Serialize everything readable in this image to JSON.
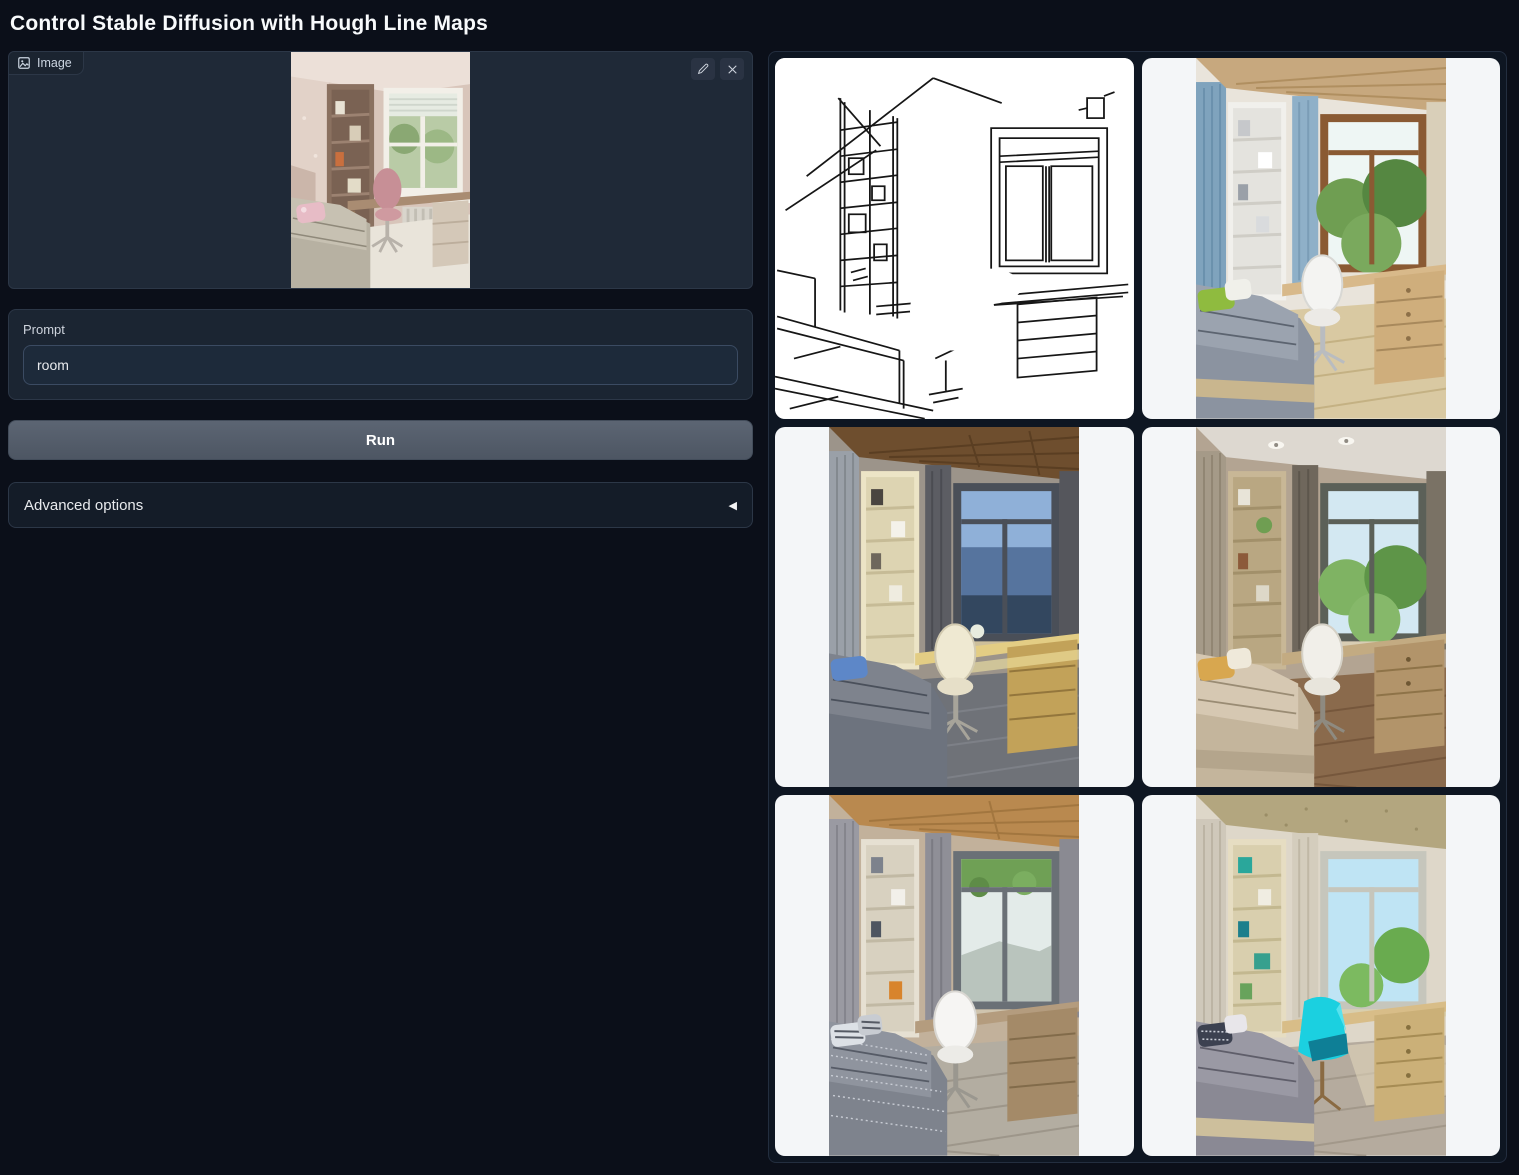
{
  "page": {
    "title": "Control Stable Diffusion with Hough Line Maps"
  },
  "input_panel": {
    "label": "Image"
  },
  "prompt": {
    "label": "Prompt",
    "value": "room"
  },
  "actions": {
    "run_label": "Run"
  },
  "advanced": {
    "label": "Advanced options",
    "collapse_icon": "◀"
  },
  "gallery": {
    "items": [
      {
        "name": "hough-line-map"
      },
      {
        "name": "generated-room-blue-curtains"
      },
      {
        "name": "generated-room-evening-wood-ceiling"
      },
      {
        "name": "generated-room-beige-bed-green-view"
      },
      {
        "name": "generated-room-gray-patterned-bed"
      },
      {
        "name": "generated-room-cyan-chair"
      }
    ]
  },
  "colors": {
    "page_bg": "#0b0f19",
    "panel_bg": "#1b2532",
    "card_bg": "#f4f6f8",
    "run_button": "#545d6b",
    "accent_cyan": "#1bd0e0"
  }
}
